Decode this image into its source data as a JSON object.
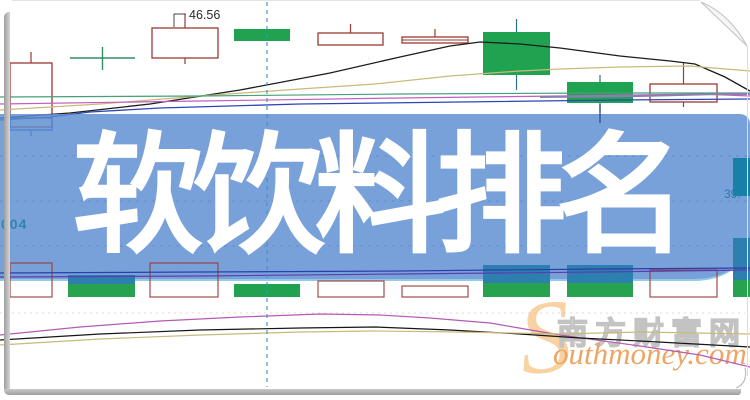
{
  "banner": {
    "title": "软饮料排名",
    "bg_color": "#7da3da"
  },
  "labels": {
    "left_code": "004",
    "right_value": "39.",
    "price_annotation": "46.56"
  },
  "watermark": {
    "initial": "S",
    "cn": "南方财富网",
    "en": "outhmoney.com"
  },
  "colors": {
    "candle_outline": "#9a3a33",
    "candle_up_fill": "#ffffff",
    "candle_down_fill": "#1fa351",
    "doji": "#2f8f63",
    "hollow_blue": "#3a49b8",
    "teal_bar": "#177fa8",
    "crosshair": "#4390ba",
    "banner_blue": "#7da3da",
    "watermark_orange": "#f0a463",
    "watermark_gray": "#c3c3c3"
  },
  "chart_data": {
    "type": "candlestick",
    "title": "软饮料排名",
    "note_units": "pixel-space estimates; price axis hidden by banner overlay",
    "annotation": {
      "text": "46.56",
      "x": 189,
      "y": 19,
      "leader": [
        [
          174,
          27
        ],
        [
          174,
          14
        ],
        [
          186,
          14
        ]
      ]
    },
    "crosshair": {
      "x": 267,
      "y1": 2,
      "y2": 387,
      "color": "#4390ba"
    },
    "banner_gridlines_y": [
      156,
      201,
      246
    ],
    "price_pane": {
      "candles": [
        {
          "x": 10,
          "w": 42,
          "body_top": 63,
          "body_bottom": 127,
          "wick_top": 52,
          "wick_bottom": 127,
          "style": "hollow"
        },
        {
          "x": 10,
          "w": 42,
          "body_top": 118,
          "body_bottom": 130,
          "wick_top": 118,
          "wick_bottom": 136,
          "style": "hollow-blue"
        },
        {
          "x": 70,
          "w": 65,
          "body_top": 58,
          "body_bottom": 58,
          "wick_top": 47,
          "wick_bottom": 70,
          "style": "doji"
        },
        {
          "x": 152,
          "w": 66,
          "body_top": 28,
          "body_bottom": 58,
          "wick_top": 14,
          "wick_bottom": 64,
          "style": "hollow"
        },
        {
          "x": 234,
          "w": 56,
          "body_top": 29,
          "body_bottom": 41,
          "wick_top": 29,
          "wick_bottom": 41,
          "style": "filled"
        },
        {
          "x": 318,
          "w": 65,
          "body_top": 33,
          "body_bottom": 45,
          "wick_top": 24,
          "wick_bottom": 45,
          "style": "hollow"
        },
        {
          "x": 402,
          "w": 66,
          "body_top": 37,
          "body_bottom": 43,
          "wick_top": 29,
          "wick_bottom": 43,
          "style": "hollow",
          "midline": true
        },
        {
          "x": 483,
          "w": 67,
          "body_top": 32,
          "body_bottom": 75,
          "wick_top": 19,
          "wick_bottom": 90,
          "style": "filled"
        },
        {
          "x": 567,
          "w": 66,
          "body_top": 82,
          "body_bottom": 103,
          "wick_top": 75,
          "wick_bottom": 112,
          "style": "filled"
        },
        {
          "x": 650,
          "w": 67,
          "body_top": 84,
          "body_bottom": 102,
          "wick_top": 63,
          "wick_bottom": 107,
          "style": "hollow"
        }
      ],
      "ma_lines": [
        {
          "name": "ma-black",
          "color": "#1c1c1c",
          "width": 1.3,
          "points": [
            [
              0,
              118
            ],
            [
              70,
              113
            ],
            [
              150,
              104
            ],
            [
              240,
              90
            ],
            [
              330,
              73
            ],
            [
              400,
              57
            ],
            [
              450,
              46
            ],
            [
              480,
              42
            ],
            [
              520,
              44
            ],
            [
              560,
              48
            ],
            [
              620,
              56
            ],
            [
              670,
              61
            ],
            [
              695,
              64
            ],
            [
              725,
              77
            ],
            [
              750,
              91
            ]
          ]
        },
        {
          "name": "ma-tan",
          "color": "#c9b97c",
          "width": 1.2,
          "points": [
            [
              0,
              110
            ],
            [
              100,
              104
            ],
            [
              200,
              96
            ],
            [
              300,
              89
            ],
            [
              375,
              84
            ],
            [
              450,
              76
            ],
            [
              520,
              71
            ],
            [
              560,
              69
            ],
            [
              620,
              67
            ],
            [
              690,
              66
            ],
            [
              750,
              71
            ]
          ]
        },
        {
          "name": "ma-green",
          "color": "#43a07a",
          "width": 1.2,
          "points": [
            [
              0,
              97
            ],
            [
              200,
              96
            ],
            [
              400,
              94
            ],
            [
              600,
              93
            ],
            [
              750,
              93
            ]
          ]
        },
        {
          "name": "ma-magenta",
          "color": "#c05fc0",
          "width": 1.2,
          "points": [
            [
              0,
              104
            ],
            [
              200,
              101
            ],
            [
              400,
              98
            ],
            [
              560,
              96
            ],
            [
              700,
              94
            ],
            [
              750,
              96
            ]
          ]
        },
        {
          "name": "ma-blue",
          "color": "#2c46b8",
          "width": 1.3,
          "points": [
            [
              0,
              120
            ],
            [
              50,
              117
            ],
            [
              90,
              112
            ],
            [
              160,
              108
            ],
            [
              300,
              104
            ],
            [
              460,
              102
            ],
            [
              620,
              100
            ],
            [
              750,
              99
            ]
          ]
        },
        {
          "name": "ma-violet",
          "color": "#8b7fae",
          "width": 2,
          "points": [
            [
              540,
              97
            ],
            [
              640,
              96
            ],
            [
              720,
              94
            ],
            [
              750,
              94
            ]
          ]
        }
      ]
    },
    "volume_pane": {
      "baseline": 297,
      "bars": [
        {
          "x": 10,
          "w": 42,
          "top": 263,
          "style": "hollow"
        },
        {
          "x": 68,
          "w": 67,
          "top": 275,
          "style": "blue-green",
          "split": 284
        },
        {
          "x": 150,
          "w": 68,
          "top": 263,
          "style": "hollow"
        },
        {
          "x": 234,
          "w": 66,
          "top": 284,
          "style": "green"
        },
        {
          "x": 318,
          "w": 66,
          "top": 281,
          "style": "hollow"
        },
        {
          "x": 402,
          "w": 66,
          "top": 286,
          "style": "hollow"
        },
        {
          "x": 483,
          "w": 67,
          "top": 265,
          "style": "blue-green",
          "split": 283
        },
        {
          "x": 567,
          "w": 66,
          "top": 265,
          "style": "blue-green",
          "split": 283
        },
        {
          "x": 650,
          "w": 67,
          "top": 270,
          "style": "hollow"
        },
        {
          "x": 733,
          "w": 17,
          "top": 238,
          "style": "blue-green",
          "split": 280
        }
      ],
      "lines": [
        {
          "name": "vol-ma-navy",
          "color": "#2a3fae",
          "width": 1.2,
          "points": [
            [
              0,
              273
            ],
            [
              200,
              272
            ],
            [
              400,
              271
            ],
            [
              600,
              269
            ],
            [
              750,
              268
            ]
          ]
        },
        {
          "name": "vol-ma-purple",
          "color": "#5a3fae",
          "width": 1.2,
          "points": [
            [
              0,
              277
            ],
            [
              200,
              276
            ],
            [
              400,
              274
            ],
            [
              600,
              272
            ],
            [
              750,
              270
            ]
          ]
        }
      ]
    },
    "indicator_pane": {
      "dotted_gridline_y": 313,
      "lines": [
        {
          "name": "ind-magenta",
          "color": "#b55ab5",
          "width": 1.2,
          "points": [
            [
              0,
              335
            ],
            [
              80,
              327
            ],
            [
              160,
              321
            ],
            [
              240,
              317
            ],
            [
              320,
              314
            ],
            [
              380,
              315
            ],
            [
              430,
              318
            ],
            [
              490,
              323
            ],
            [
              560,
              335
            ],
            [
              640,
              346
            ],
            [
              700,
              355
            ],
            [
              750,
              367
            ]
          ]
        },
        {
          "name": "ind-black",
          "color": "#161616",
          "width": 1.2,
          "points": [
            [
              0,
              340
            ],
            [
              100,
              334
            ],
            [
              200,
              330
            ],
            [
              300,
              328
            ],
            [
              375,
              327
            ],
            [
              450,
              330
            ],
            [
              520,
              334
            ],
            [
              580,
              338
            ],
            [
              640,
              341
            ],
            [
              750,
              347
            ]
          ]
        },
        {
          "name": "ind-tan",
          "color": "#c9b97c",
          "width": 1.2,
          "points": [
            [
              0,
              345
            ],
            [
              100,
              339
            ],
            [
              200,
              335
            ],
            [
              300,
              332
            ],
            [
              375,
              331
            ],
            [
              460,
              332
            ],
            [
              560,
              334
            ],
            [
              640,
              332
            ],
            [
              750,
              334
            ]
          ]
        }
      ]
    },
    "overlay_elements": {
      "right_teal_bar": {
        "x": 733,
        "w": 17,
        "top": 158,
        "bottom": 196,
        "color": "#177fa8"
      },
      "extra_lines": [
        {
          "name": "candle8-lower-wick",
          "color": "#2a4f86",
          "width": 1.3,
          "points": [
            [
              600,
              104
            ],
            [
              600,
              123
            ]
          ]
        }
      ]
    }
  }
}
